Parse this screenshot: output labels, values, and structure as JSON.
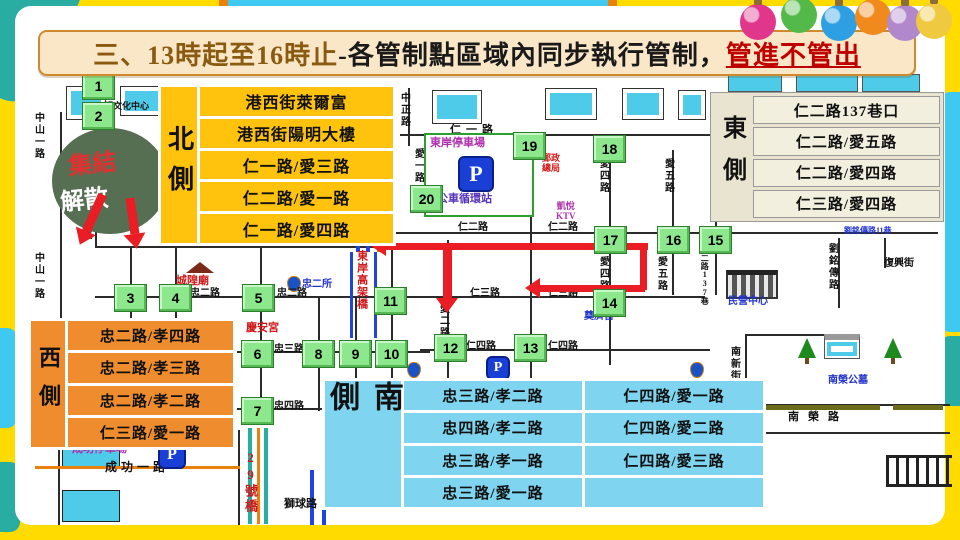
{
  "title": {
    "prefix": "三、13時起至16時止",
    "middle": "-各管制點區域內同步執行管制，",
    "highlight": "管進不管出"
  },
  "side_boxes": {
    "north": {
      "label": "北側",
      "items": [
        "港西街萊爾富",
        "港西街陽明大樓",
        "仁一路/愛三路",
        "仁二路/愛一路",
        "仁一路/愛四路"
      ]
    },
    "east": {
      "label": "東側",
      "items": [
        "仁二路137巷口",
        "仁二路/愛五路",
        "仁二路/愛四路",
        "仁三路/愛四路"
      ]
    },
    "west": {
      "label": "西側",
      "items": [
        "忠二路/孝四路",
        "忠二路/孝三路",
        "忠二路/孝二路",
        "仁三路/愛一路"
      ]
    },
    "south": {
      "label": "南側",
      "col1": [
        "忠三路/孝二路",
        "忠四路/孝二路",
        "忠三路/孝一路",
        "忠三路/愛一路"
      ],
      "col2": [
        "仁四路/愛一路",
        "仁四路/愛二路",
        "仁四路/愛三路"
      ]
    }
  },
  "markers": [
    "1",
    "2",
    "3",
    "4",
    "5",
    "6",
    "7",
    "8",
    "9",
    "10",
    "11",
    "12",
    "13",
    "14",
    "15",
    "16",
    "17",
    "18",
    "19",
    "20"
  ],
  "streets": {
    "zhongshan1_a": "中山一路",
    "zhongshan1_b": "中山一路",
    "zhong1_v": "忠一路",
    "zhong1_h": "忠一路",
    "zhong2_a": "忠二路",
    "zhong2_b": "忠二路",
    "zhong3": "忠三路",
    "zhong4": "忠四路",
    "ren1": "仁一路",
    "ren2_a": "仁二路",
    "ren2_b": "仁二路",
    "ren3_a": "仁三路",
    "ren3_b": "仁三路",
    "ren4_a": "仁四路",
    "ren4_b": "仁四路",
    "zhongzheng": "中正路",
    "ai1": "愛一路",
    "ai2": "愛二路",
    "ai3": "愛三路",
    "ai4_a": "愛四路",
    "ai4_b": "愛四路",
    "ai5_a": "愛五路",
    "ai5_b": "愛五路",
    "ren2_lane": "仁二路137巷",
    "chenggong1": "成功一路",
    "shiqiu": "獅球路",
    "fuxing": "復興街",
    "liuming_lane": "劉銘傳路11巷",
    "liuming": "劉銘傳路",
    "nanxin": "南新街",
    "nanrong": "南榮路",
    "bridge29": "29號橋",
    "viaduct": "東岸高架橋"
  },
  "landmarks": {
    "culture": "明文化中心",
    "chenghuang": "城隍廟",
    "qingan": "慶安宮",
    "zhong2_police": "忠二所",
    "dianji": "奠濟宮",
    "post": "郵政\n總局",
    "ktv": "凱悅\nKTV",
    "heping": "和平所",
    "minying": "民營中心",
    "cemetery": "南榮公墓",
    "east_parking": "東岸停車場",
    "bus_loop": "公車循環站",
    "chenggong_parking": "成功停車場"
  },
  "assembly": {
    "line1": "集結",
    "line2": "解散"
  },
  "parking_label": "P",
  "ornament_colors": [
    "#e0368c",
    "#53b948",
    "#2f9fe3",
    "#f08a1d",
    "#b288cc",
    "#efc93f"
  ],
  "accent_colors": {
    "north_box": "#ffc20d",
    "west_box": "#ee8c2e",
    "south_box": "#7fd4f0",
    "east_box": "#f3efdf",
    "route_red": "#ea1c24",
    "marker_green": "#8de88d",
    "frame_yellow": "#ffdb00",
    "frame_teal": "#29ada2",
    "frame_cyan": "#3fc9f0"
  }
}
